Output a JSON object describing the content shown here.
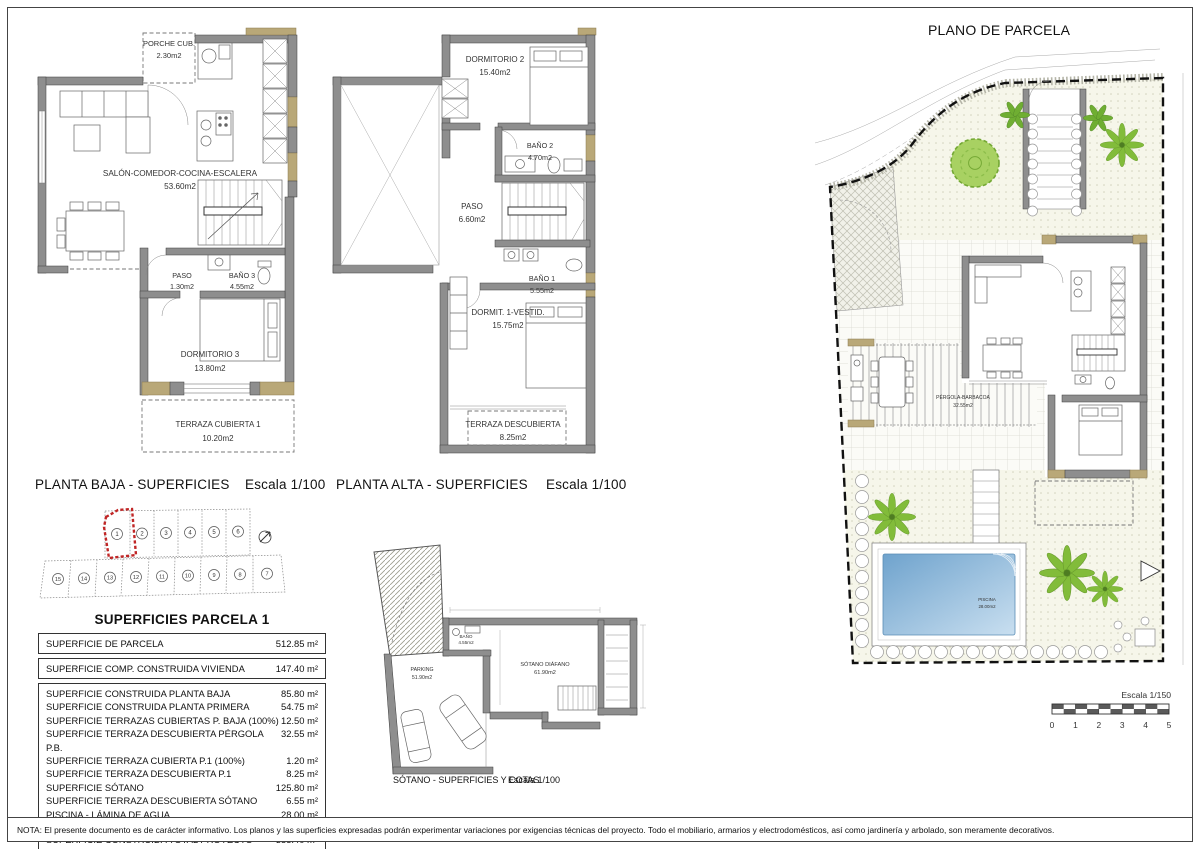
{
  "sheet": {
    "note": "NOTA: El presente documento es de carácter informativo. Los planos y las superficies expresadas podrán experimentar variaciones por exigencias técnicas del proyecto. Todo el mobiliario, armarios y electrodomésticos, así como jardinería y arbolado, son meramente decorativos."
  },
  "colors": {
    "wall_gray": "#8e8e8e",
    "accent_tan": "#b9a878",
    "lot_highlight_red": "#c02626",
    "tree_green": "#82bc3a",
    "pool_blue": "#7fb0d6",
    "garden_cream": "#f6f6ea"
  },
  "ground_floor": {
    "title": "PLANTA BAJA - SUPERFICIES",
    "scale": "Escala 1/100",
    "porche": {
      "name": "PORCHE CUB.",
      "area": "2.30m2"
    },
    "salon": {
      "name": "SALÓN-COMEDOR-COCINA-ESCALERA",
      "area": "53.60m2"
    },
    "paso": {
      "name": "PASO",
      "area": "1.30m2"
    },
    "bano3": {
      "name": "BAÑO 3",
      "area": "4.55m2"
    },
    "dormitorio3": {
      "name": "DORMITORIO 3",
      "area": "13.80m2"
    },
    "terraza": {
      "name": "TERRAZA CUBIERTA 1",
      "area": "10.20m2"
    }
  },
  "upper_floor": {
    "title": "PLANTA ALTA - SUPERFICIES",
    "scale": "Escala 1/100",
    "dormitorio2": {
      "name": "DORMITORIO 2",
      "area": "15.40m2"
    },
    "bano2": {
      "name": "BAÑO 2",
      "area": "4.70m2"
    },
    "paso": {
      "name": "PASO",
      "area": "6.60m2"
    },
    "bano1": {
      "name": "BAÑO 1",
      "area": "5.55m2"
    },
    "dormitorio1": {
      "name": "DORMIT. 1-VESTID.",
      "area": "15.75m2"
    },
    "terraza": {
      "name": "TERRAZA DESCUBIERTA",
      "area": "8.25m2"
    }
  },
  "basement": {
    "title": "SÓTANO - SUPERFICIES Y COTAS",
    "scale": "Escala 1/100",
    "bano": {
      "name": "BAÑO",
      "area": "4.55m2"
    },
    "parking": {
      "name": "PARKING",
      "area": "51.90m2"
    },
    "diafano": {
      "name": "SÓTANO DIÁFANO",
      "area": "61.90m2"
    }
  },
  "parcel_plan": {
    "title": "PLANO DE PARCELA",
    "pergola": {
      "name": "PÉRGOLA-BARBACOA",
      "area": "32.55m2"
    },
    "piscina": {
      "name": "PISCINA",
      "area": "28.00m2"
    },
    "scale_label": "Escala 1/150",
    "scale_ticks": [
      "0",
      "1",
      "2",
      "3",
      "4",
      "5"
    ]
  },
  "lots": {
    "top": [
      "1",
      "2",
      "3",
      "4",
      "5",
      "6"
    ],
    "bottom": [
      "15",
      "14",
      "13",
      "12",
      "11",
      "10",
      "9",
      "8",
      "7"
    ]
  },
  "table": {
    "title": "SUPERFICIES PARCELA 1",
    "top_rows": [
      {
        "label": "SUPERFICIE DE PARCELA",
        "value": "512.85 m²"
      },
      {
        "label": "SUPERFICIE COMP. CONSTRUIDA VIVIENDA",
        "value": "147.40 m²"
      }
    ],
    "mid_rows": [
      {
        "label": "SUPERFICIE CONSTRUIDA PLANTA BAJA",
        "value": "85.80 m²"
      },
      {
        "label": "SUPERFICIE CONSTRUIDA PLANTA PRIMERA",
        "value": "54.75 m²"
      },
      {
        "label": "SUPERFICIE TERRAZAS CUBIERTAS P. BAJA (100%)",
        "value": "12.50 m²"
      },
      {
        "label": "SUPERFICIE TERRAZA DESCUBIERTA PÉRGOLA P.B.",
        "value": "32.55 m²"
      },
      {
        "label": "SUPERFICIE TERRAZA CUBIERTA P.1 (100%)",
        "value": "1.20 m²"
      },
      {
        "label": "SUPERFICIE TERRAZA DESCUBIERTA P.1",
        "value": "8.25 m²"
      },
      {
        "label": "SUPERFICIE SÓTANO",
        "value": "125.80 m²"
      },
      {
        "label": "SUPERFICIE TERRAZA DESCUBIERTA SÓTANO",
        "value": "6.55 m²"
      },
      {
        "label": "PISCINA - LÁMINA DE AGUA",
        "value": "28.00 m²"
      }
    ],
    "total_row": {
      "label": "SUPERFICIE CONSTRUIDA TOTAL PROYECTO",
      "value": "355.40 m²"
    }
  }
}
